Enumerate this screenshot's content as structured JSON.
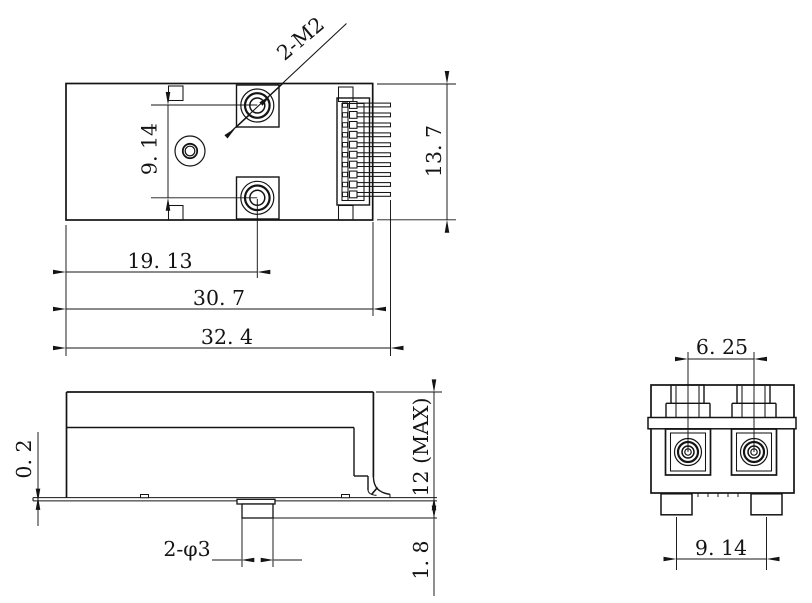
{
  "drawing": {
    "title": "transceiver-module-3-view-dimension-drawing",
    "background": "#ffffff",
    "line_color": "#141414",
    "labels": {
      "thread_callout": "2-M2",
      "top_hole_spacing": "9. 14",
      "top_hole_offset": "19. 13",
      "top_body_length": "30. 7",
      "top_overall_length": "32. 4",
      "top_width": "13. 7",
      "side_standoff": "0. 2",
      "side_height_max": "12 (MAX)",
      "side_post_callout": "2-φ3",
      "side_post_protrusion": "1. 8",
      "end_port_spacing": "6. 25",
      "end_post_spacing": "9. 14"
    }
  }
}
